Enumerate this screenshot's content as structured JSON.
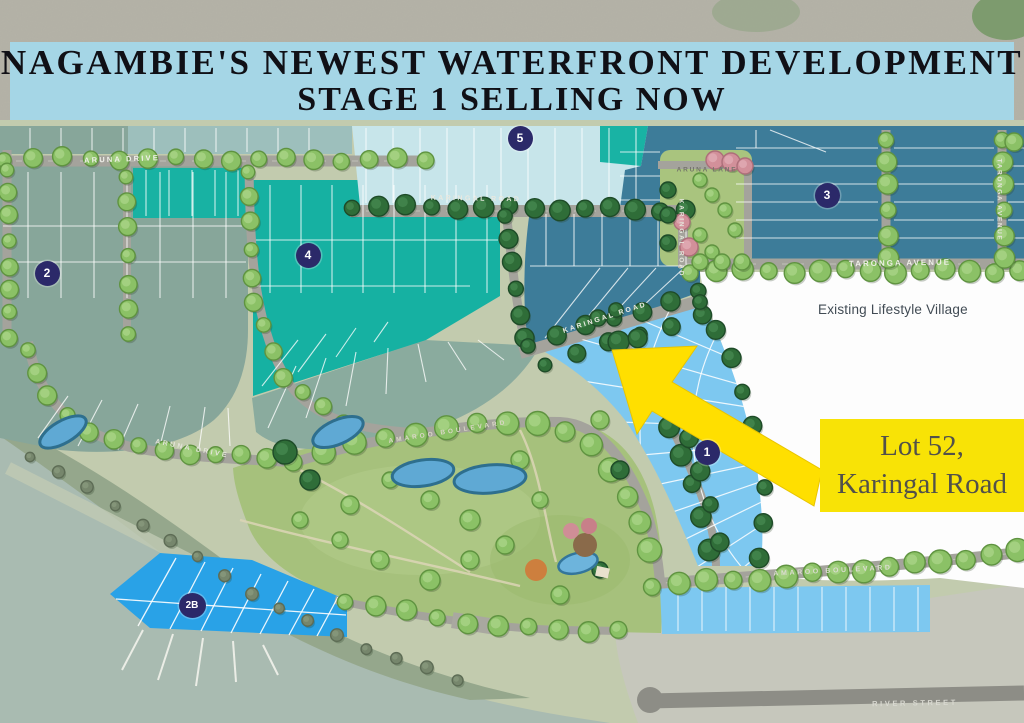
{
  "banner": {
    "line1": "NAGAMBIE'S NEWEST WATERFRONT DEVELOPMENT",
    "line2": "STAGE 1 SELLING NOW"
  },
  "annotations": {
    "existing_village": "Existing Lifestyle Village",
    "callout_line1": "Lot 52,",
    "callout_line2": "Karingal Road"
  },
  "street_labels": [
    {
      "id": "aruna-drive-top",
      "text": "ARUNA DRIVE",
      "x": 122,
      "y": 159,
      "rot": -2,
      "size": 7.5,
      "ls": 2.2,
      "color": "#f0f0ea"
    },
    {
      "id": "karingal-road-top",
      "text": "KARINGAL ROAD",
      "x": 476,
      "y": 199,
      "rot": 1,
      "size": 7,
      "ls": 2.4,
      "color": "#e9e9e0"
    },
    {
      "id": "karingal-road-diagonal",
      "text": "KARINGAL ROAD",
      "x": 605,
      "y": 318,
      "rot": -18,
      "size": 7,
      "ls": 2.2,
      "color": "#eeeee6"
    },
    {
      "id": "karingal-road-vertical",
      "text": "KARINGAL ROAD",
      "x": 681,
      "y": 238,
      "rot": 90,
      "size": 6.5,
      "ls": 1.8,
      "color": "#e5e5dc"
    },
    {
      "id": "aruna-lane",
      "text": "ARUNA LANE",
      "x": 707,
      "y": 170,
      "rot": 0,
      "size": 6.5,
      "ls": 1.8,
      "color": "#74746a"
    },
    {
      "id": "taronga-avenue",
      "text": "TARONGA AVENUE",
      "x": 900,
      "y": 263,
      "rot": -1,
      "size": 8,
      "ls": 2,
      "color": "#ececе4"
    },
    {
      "id": "taronga-avenue-vertical",
      "text": "TARONGA AVENUE",
      "x": 999,
      "y": 200,
      "rot": 90,
      "size": 6.5,
      "ls": 1.6,
      "color": "#e5e5dc"
    },
    {
      "id": "aruna-drive-south",
      "text": "ARUNA DRIVE",
      "x": 192,
      "y": 449,
      "rot": 11,
      "size": 7,
      "ls": 2.4,
      "color": "#e4e4da"
    },
    {
      "id": "amaroo-boulevard-park",
      "text": "AMAROO BOULEVARD",
      "x": 448,
      "y": 432,
      "rot": -9,
      "size": 6.5,
      "ls": 3,
      "color": "#d9d6c6"
    },
    {
      "id": "amaroo-boulevard",
      "text": "AMAROO BOULEVARD",
      "x": 833,
      "y": 571,
      "rot": -3,
      "size": 7,
      "ls": 2.6,
      "color": "#dcdcd2"
    },
    {
      "id": "river-street",
      "text": "RIVER STREET",
      "x": 915,
      "y": 703,
      "rot": -1,
      "size": 7.5,
      "ls": 2.6,
      "color": "#d8d8d0"
    }
  ],
  "stage_markers": [
    {
      "id": "1",
      "label": "1",
      "x": 707,
      "y": 452
    },
    {
      "id": "2",
      "label": "2",
      "x": 47,
      "y": 273
    },
    {
      "id": "2B",
      "label": "2B",
      "x": 192,
      "y": 605
    },
    {
      "id": "3",
      "label": "3",
      "x": 827,
      "y": 195
    },
    {
      "id": "4",
      "label": "4",
      "x": 308,
      "y": 255
    },
    {
      "id": "5",
      "label": "5",
      "x": 520,
      "y": 138
    }
  ],
  "colors": {
    "banner_bg": "#a5d6e6",
    "banner_text": "#101016",
    "stage1_light_blue": "#7dc8f0",
    "stage2b_marina_blue": "#29a2e7",
    "stage4_teal": "#16b1a2",
    "stage5_pale_blue": "#c7e5ea",
    "steel_blue_lots": "#3d7c99",
    "sage_lots": "#87a69a",
    "callout_yellow": "#f8e306",
    "arrow_yellow": "#ffdf00",
    "marker_navy": "#2b2969",
    "park_green": "#a6c17c",
    "water": "#a9bbb1",
    "road_gray": "#a4a39c",
    "river_street_gray": "#8d8d86",
    "village_white": "#fdfdfd"
  }
}
